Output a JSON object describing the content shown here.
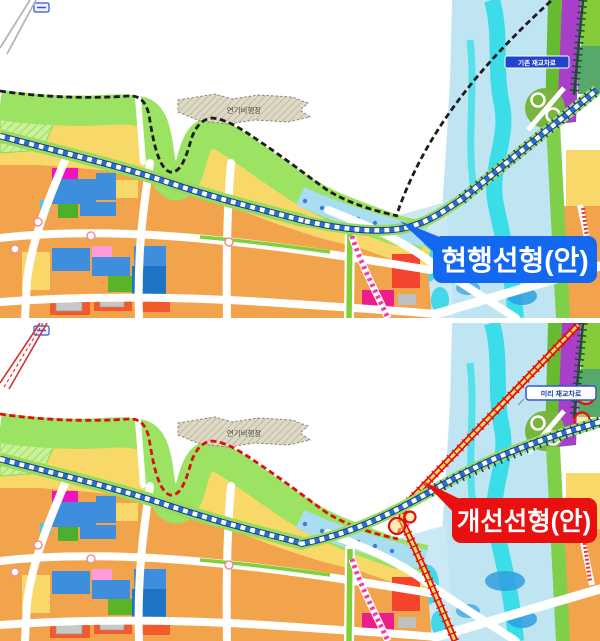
{
  "image": {
    "kind": "alignment-comparison-map",
    "width": 600,
    "height": 641
  },
  "shared": {
    "airfield_label": "연기비행장"
  },
  "panels": [
    {
      "name": "current-alignment",
      "callout": {
        "label": "현행선형(안)",
        "bg_color": "#1468F0",
        "text_color": "#FFFFFF"
      },
      "crossing_label": {
        "text": "기존 재교차로",
        "bg_color": "#2244CC",
        "text_color": "#FFFFFF"
      },
      "alignment_line_color": "#1C1C1C"
    },
    {
      "name": "improved-alignment",
      "callout": {
        "label": "개선선형(안)",
        "bg_color": "#EA1010",
        "text_color": "#FFFFFF"
      },
      "crossing_label": {
        "text": "미리 재교차로",
        "bg_color": "#FFFFFF",
        "text_color": "#1B3FAA"
      },
      "alignment_line_color": "#DD1010"
    }
  ],
  "palette": {
    "land_yellow": "#F8D869",
    "land_orange": "#F2A44C",
    "riparian_green": "#9CE263",
    "stream_water": "#8ED7EA",
    "river_water": "#BFE4F2",
    "river_channel_cyan": "#3ADDE8",
    "rail_navy": "#123C8C",
    "rail_blue_dash": "#2E6BD6",
    "purple_strip": "#A93FC9",
    "commercial_red": "#F2592B",
    "parcel_blue": "#3E8EDD",
    "parcel_green": "#4CAF2E",
    "parcel_magenta": "#F012BE",
    "brt_pink": "#F03FA8"
  }
}
